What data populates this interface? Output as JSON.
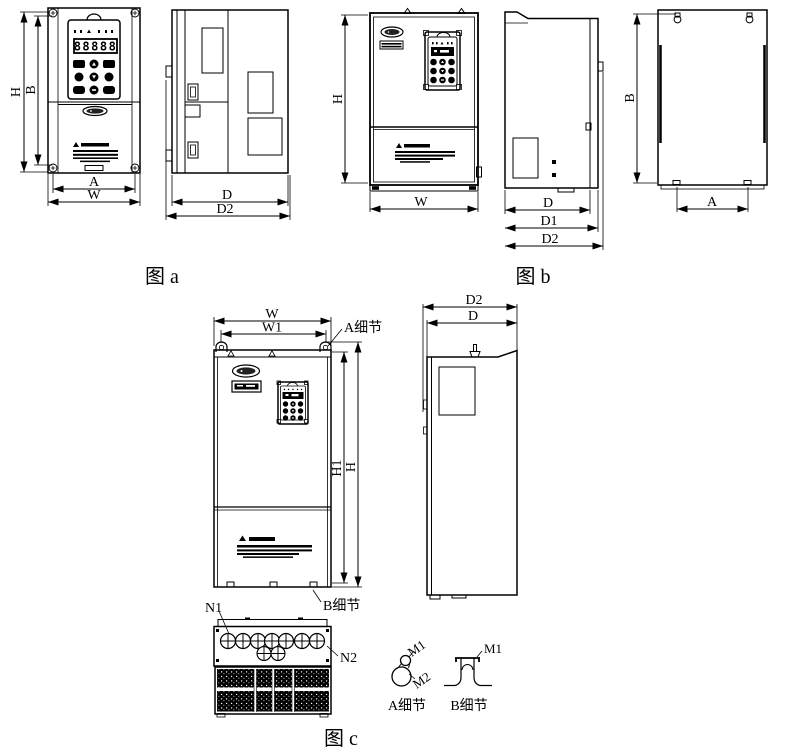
{
  "figure_a": {
    "caption": "图 a",
    "front": {
      "dim_h": "H",
      "dim_b": "B",
      "dim_a": "A",
      "dim_w": "W",
      "display": "88888"
    },
    "side": {
      "dim_d": "D",
      "dim_d2": "D2"
    }
  },
  "figure_b": {
    "caption": "图 b",
    "front": {
      "dim_h": "H",
      "dim_w": "W"
    },
    "side": {
      "dim_d": "D",
      "dim_d1": "D1",
      "dim_d2": "D2"
    },
    "back": {
      "dim_b": "B",
      "dim_a": "A"
    }
  },
  "figure_c": {
    "caption": "图 c",
    "front": {
      "dim_w": "W",
      "dim_w1": "W1",
      "dim_h1": "H1",
      "dim_h": "H",
      "detail_a_callout": "A细节",
      "detail_b_callout": "B细节"
    },
    "bottom": {
      "n1": "N1",
      "n2": "N2"
    },
    "side": {
      "dim_d2": "D2",
      "dim_d": "D"
    },
    "detail_a": {
      "caption": "A细节",
      "m1": "M1",
      "m2": "M2"
    },
    "detail_b": {
      "caption": "B细节",
      "m1": "M1"
    }
  }
}
